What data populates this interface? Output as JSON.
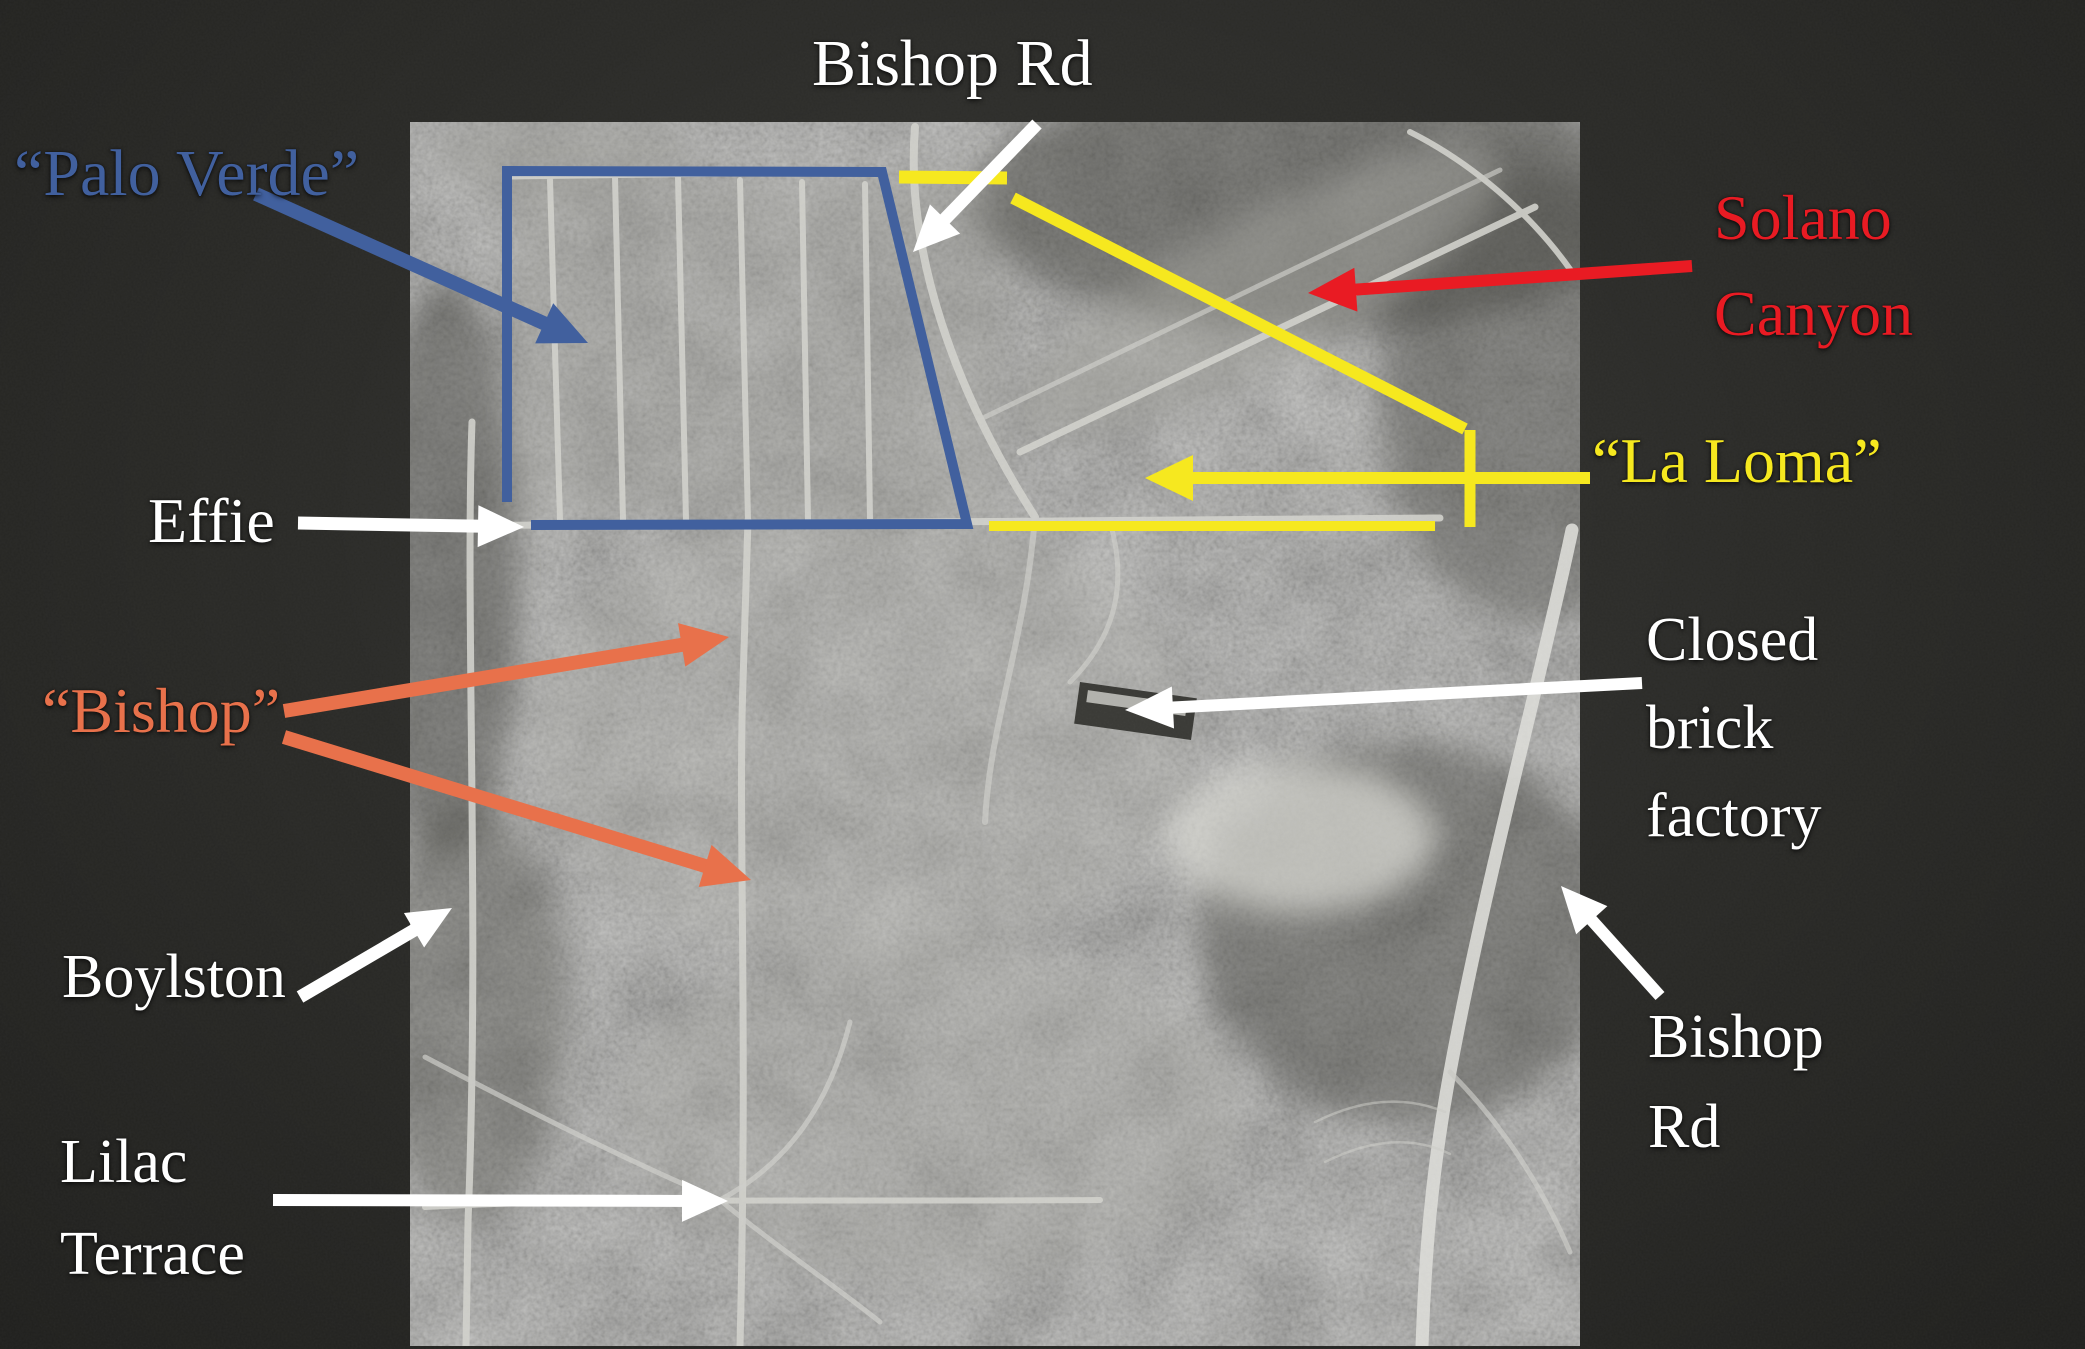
{
  "slide": {
    "labels": {
      "bishop_rd_top": "Bishop Rd",
      "palo_verde": "“Palo Verde”",
      "solano_line1": "Solano",
      "solano_line2": "Canyon",
      "la_loma": "“La Loma”",
      "effie": "Effie",
      "bishop_quoted": "“Bishop”",
      "brick_line1": "Closed",
      "brick_line2": "brick",
      "brick_line3": "factory",
      "boylston": "Boylston",
      "bishop_rd_right_line1": "Bishop",
      "bishop_rd_right_line2": "Rd",
      "lilac_line1": "Lilac",
      "lilac_line2": "Terrace"
    },
    "colors": {
      "palo_verde_blue": "#41609E",
      "la_loma_yellow": "#F6E81F",
      "solano_red": "#E91B23",
      "bishop_orange": "#E8714B",
      "white": "#FFFFFF",
      "background": "#2A2A27"
    }
  }
}
